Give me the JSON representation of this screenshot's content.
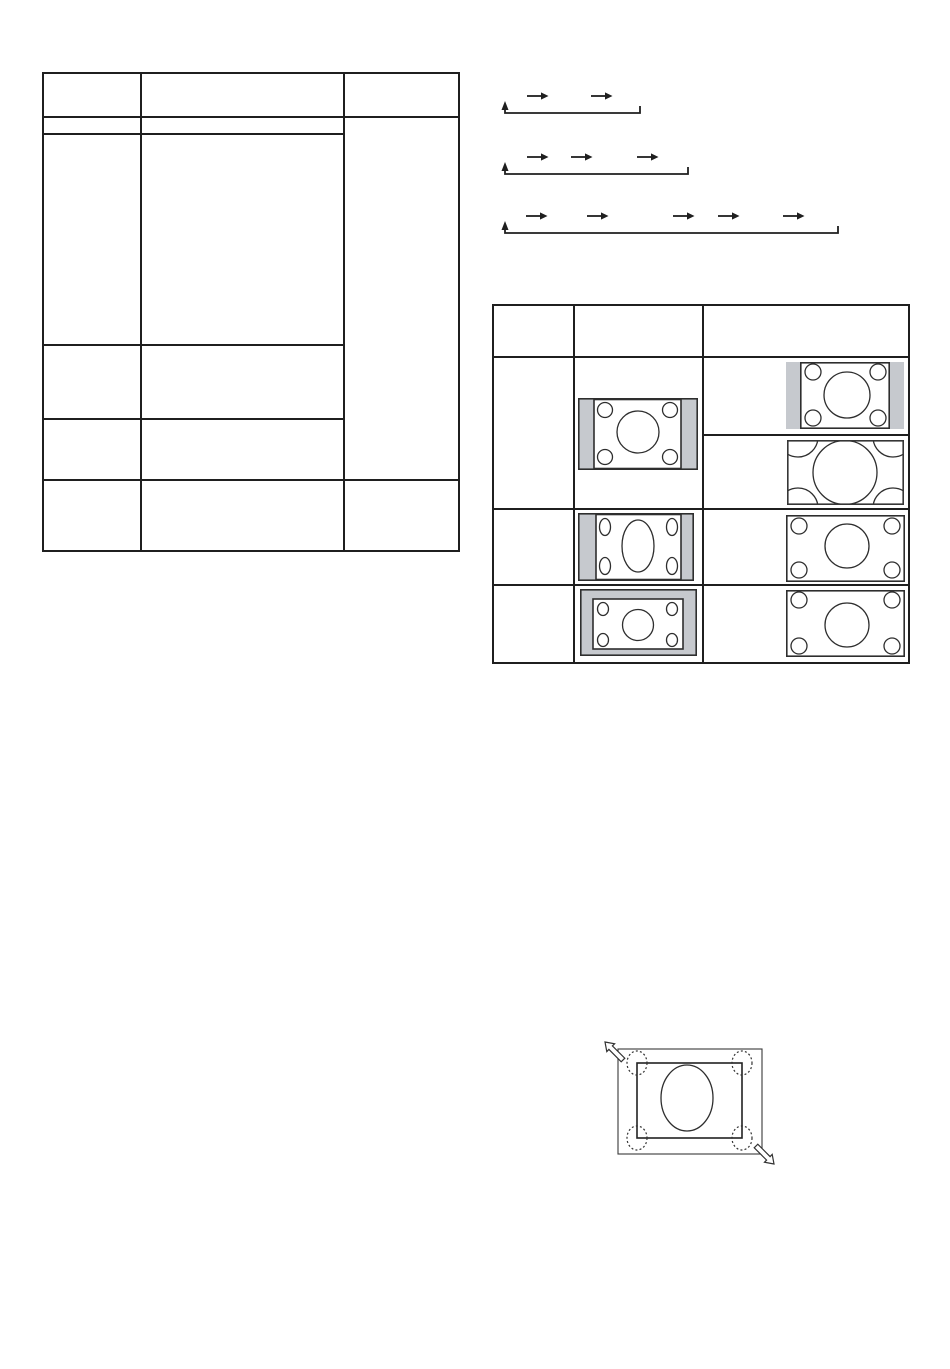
{
  "document": {
    "kind": "manual-page-graphics-only",
    "visible_text": ""
  },
  "colors": {
    "paper": "#ffffff",
    "line": "#1f1f1f",
    "stroke": "#2e2e2e",
    "gray": "#c6c9ce"
  },
  "left_table": {
    "columns": 3,
    "header_rows": 1,
    "body_rows": 4,
    "merged_third_column_body_cell": true,
    "footer_rows": 1,
    "cell_text": ""
  },
  "cycle_diagrams": [
    {
      "name": "two-step-cycle",
      "step_arrows": 2,
      "loops_back_to_start": true
    },
    {
      "name": "three-step-cycle",
      "step_arrows": 3,
      "loops_back_to_start": true
    },
    {
      "name": "five-step-cycle",
      "step_arrows": 5,
      "loops_back_to_start": true
    }
  ],
  "right_table": {
    "columns": 3,
    "body_rows": 3,
    "first_body_row_right_subcells": 2,
    "cell_text": "",
    "illustrations": [
      {
        "cell": "row1-col2",
        "type": "pillarbox-4-3-screen",
        "center_shape": "circle",
        "corner_circles": 4
      },
      {
        "cell": "row1-col3-top",
        "type": "pillarbox-4-3-screen-large",
        "center_shape": "circle",
        "corner_circles": 4
      },
      {
        "cell": "row1-col3-bottom",
        "type": "zoomed-cropped-screen",
        "center_shape": "large-clipped-circle",
        "corner_circles": 4
      },
      {
        "cell": "row2-col2",
        "type": "pillarbox-stretched-screen",
        "center_shape": "tall-ellipse",
        "corner_circles": 4
      },
      {
        "cell": "row2-col3",
        "type": "full-screen",
        "center_shape": "circle",
        "corner_circles": 4
      },
      {
        "cell": "row3-col2",
        "type": "letterbox-framed-screen",
        "center_shape": "circle",
        "corner_circles": 4
      },
      {
        "cell": "row3-col3",
        "type": "full-screen",
        "center_shape": "circle",
        "corner_circles": 4
      }
    ]
  },
  "zoom_diagram": {
    "outer_rect": true,
    "inner_rect": true,
    "center_shape": "ellipse",
    "dotted_corner_circles": 4,
    "expand_arrows": 2
  }
}
